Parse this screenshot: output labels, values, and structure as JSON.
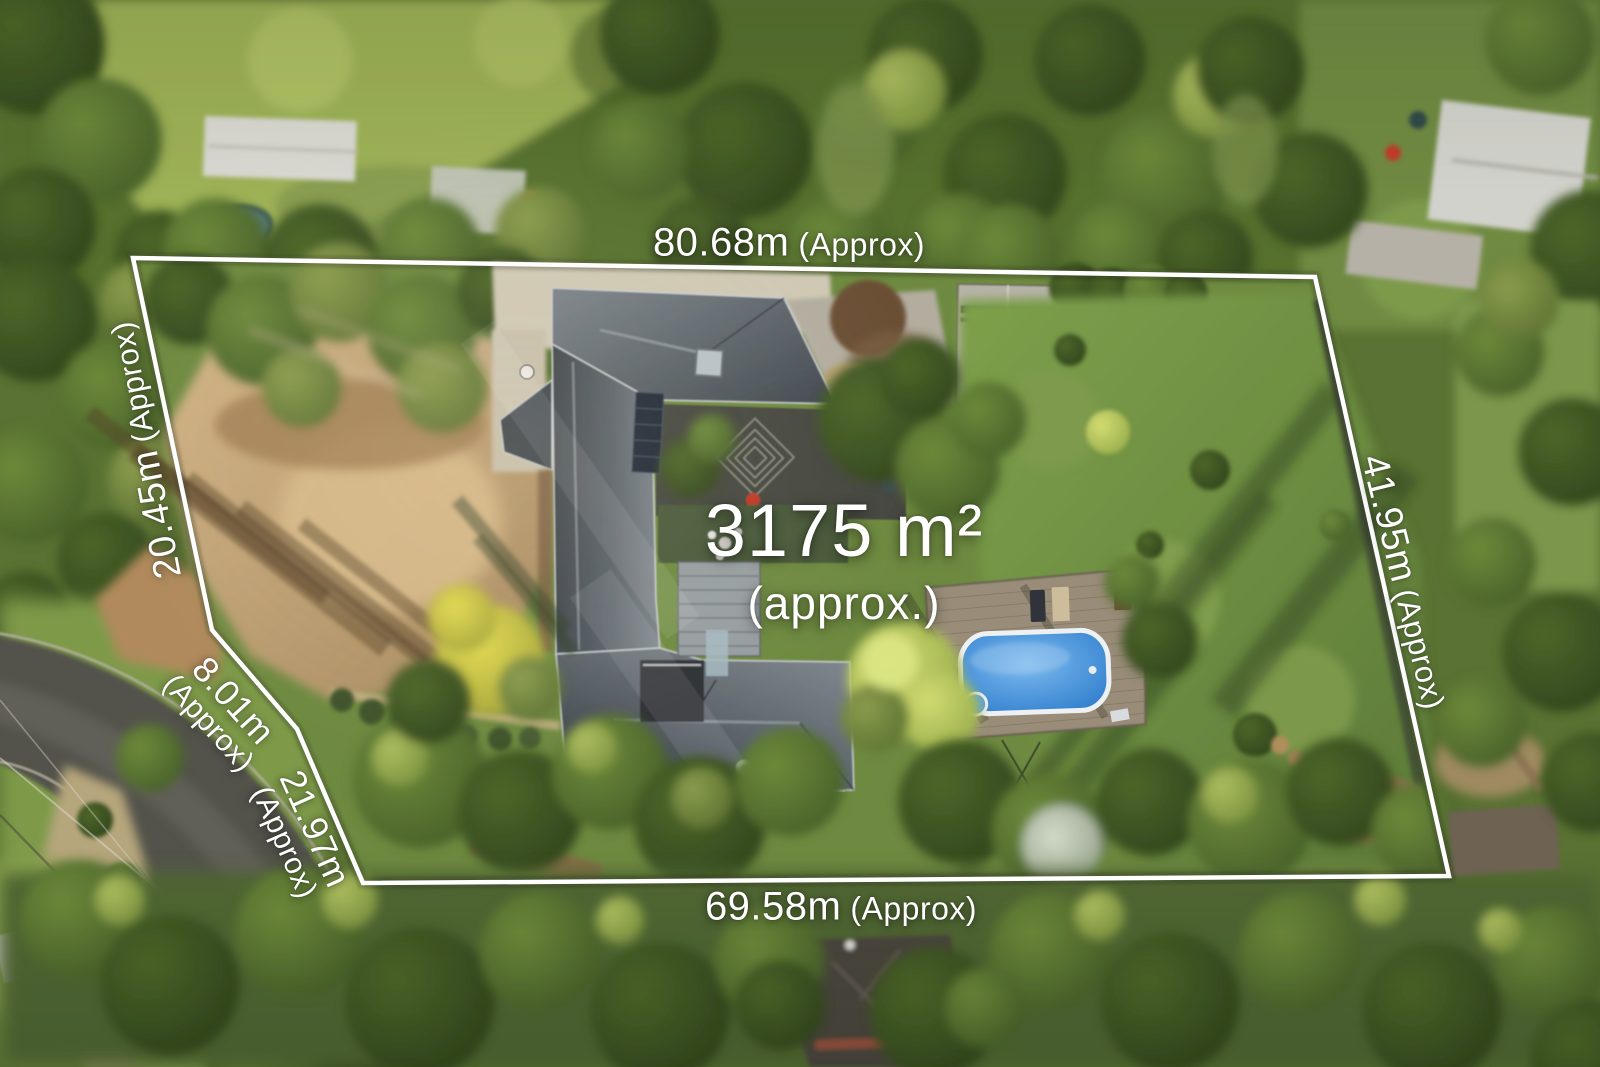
{
  "labels": {
    "area": {
      "value": "3175 m²",
      "qualifier": "(approx.)"
    },
    "top": {
      "value": "80.68m",
      "qualifier": "(Approx)"
    },
    "bottom": {
      "value": "69.58m",
      "qualifier": "(Approx)"
    },
    "left": {
      "value": "20.45m",
      "qualifier": "(Approx)"
    },
    "right": {
      "value": "41.95m",
      "qualifier": "(Approx)"
    },
    "left_segment_upper": {
      "value": "8.01m",
      "qualifier": "(Approx)"
    },
    "left_segment_lower": {
      "value": "21.97m",
      "qualifier": "(Approx)"
    }
  },
  "colors": {
    "boundary_line": "#ffffff",
    "label_text": "#ffffff",
    "pool_water": "#2e7ccc",
    "roof_slate": "#49515a",
    "deck_wood": "#998d79",
    "lawn_green": "#6f8a42",
    "dirt_tan": "#c3a170",
    "road_asphalt": "#55544e"
  }
}
